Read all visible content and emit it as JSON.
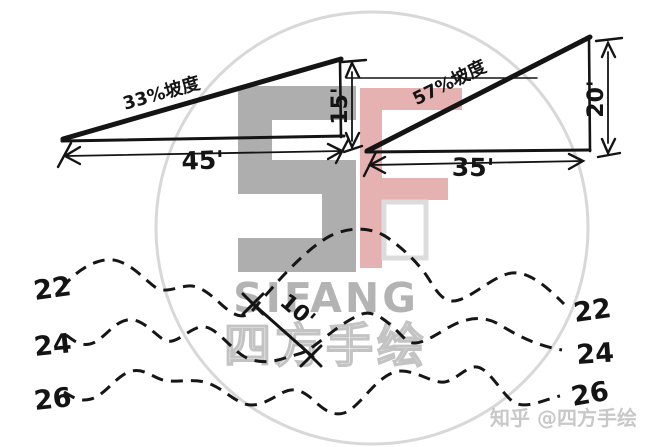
{
  "colors": {
    "ink": "#141414",
    "watermark_gray": "#a7a7a7",
    "watermark_pink": "#e2a9a9",
    "watermark_pale": "#dcdcdc",
    "circle_gray": "#d8d8d8",
    "brand_gray": "#b3b3b3",
    "attribution_gray": "#bdbdbd"
  },
  "slope_diagrams": {
    "left": {
      "slope_label": "33%坡度",
      "base": "45'",
      "height": "15'"
    },
    "right": {
      "slope_label": "57%坡度",
      "base": "35'",
      "height": "20'"
    }
  },
  "contour_plan": {
    "left_labels": [
      "22",
      "24",
      "26"
    ],
    "right_labels": [
      "22",
      "24",
      "26"
    ],
    "spacing_label": "10'"
  },
  "watermark": {
    "letter_s": "S",
    "letter_f": "F",
    "brand_latin": "SIFANG",
    "brand_cn": "四方手绘",
    "attribution": "知乎 @四方手绘"
  }
}
